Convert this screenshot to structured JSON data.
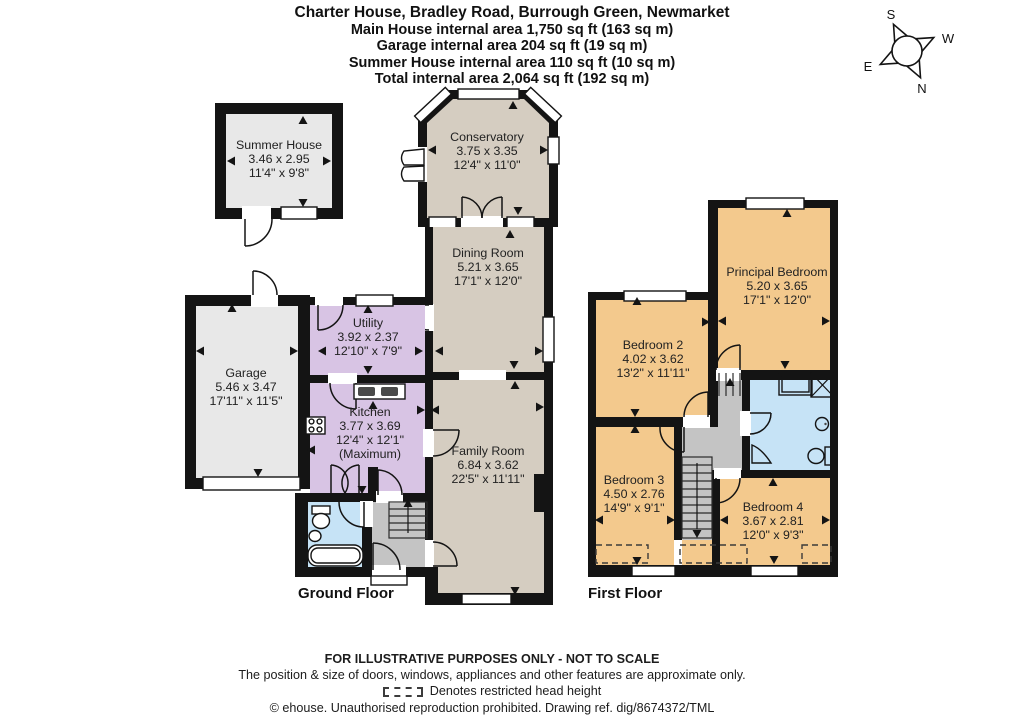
{
  "header": {
    "title": "Charter House, Bradley Road, Burrough Green, Newmarket",
    "area_lines": [
      "Main House internal area 1,750 sq ft (163 sq m)",
      "Garage internal area 204 sq ft (19 sq m)",
      "Summer House internal area 110 sq ft (10 sq m)",
      "Total internal area 2,064 sq ft (192 sq m)"
    ]
  },
  "compass": {
    "north": "N",
    "south": "S",
    "east": "E",
    "west": "W"
  },
  "floors": {
    "ground_label": "Ground Floor",
    "first_label": "First Floor"
  },
  "rooms": {
    "summer_house": {
      "name": "Summer House",
      "metric": "3.46 x 2.95",
      "imperial": "11'4\" x 9'8\""
    },
    "conservatory": {
      "name": "Conservatory",
      "metric": "3.75 x 3.35",
      "imperial": "12'4\" x 11'0\""
    },
    "dining_room": {
      "name": "Dining Room",
      "metric": "5.21 x 3.65",
      "imperial": "17'1\" x 12'0\""
    },
    "utility": {
      "name": "Utility",
      "metric": "3.92 x 2.37",
      "imperial": "12'10\" x 7'9\""
    },
    "garage": {
      "name": "Garage",
      "metric": "5.46 x 3.47",
      "imperial": "17'11\" x 11'5\""
    },
    "kitchen": {
      "name": "Kitchen",
      "metric": "3.77 x 3.69",
      "imperial": "12'4\" x 12'1\"",
      "note": "(Maximum)"
    },
    "family_room": {
      "name": "Family Room",
      "metric": "6.84 x 3.62",
      "imperial": "22'5\" x 11'11\""
    },
    "principal_bedroom": {
      "name": "Principal Bedroom",
      "metric": "5.20 x 3.65",
      "imperial": "17'1\" x 12'0\""
    },
    "bedroom_2": {
      "name": "Bedroom 2",
      "metric": "4.02 x 3.62",
      "imperial": "13'2\" x 11'11\""
    },
    "bedroom_3": {
      "name": "Bedroom 3",
      "metric": "4.50 x 2.76",
      "imperial": "14'9\" x 9'1\""
    },
    "bedroom_4": {
      "name": "Bedroom 4",
      "metric": "3.67 x 2.81",
      "imperial": "12'0\" x 9'3\""
    }
  },
  "footer": {
    "disclaimer": "FOR ILLUSTRATIVE PURPOSES ONLY - NOT TO SCALE",
    "approx_note": "The position & size of doors, windows, appliances and other features are approximate only.",
    "restricted_note": "Denotes restricted head height",
    "copyright": "© ehouse. Unauthorised reproduction prohibited. Drawing ref. dig/8674372/TML"
  },
  "colors": {
    "reception_fill": "#d5cdc1",
    "kitchen_fill": "#d8c4e4",
    "bedroom_fill": "#f3c98d",
    "bathroom_fill": "#c6e3f6",
    "garage_fill": "#e8e8e8",
    "hall_stairs_fill": "#c4c4c4",
    "wall": "#141414"
  }
}
